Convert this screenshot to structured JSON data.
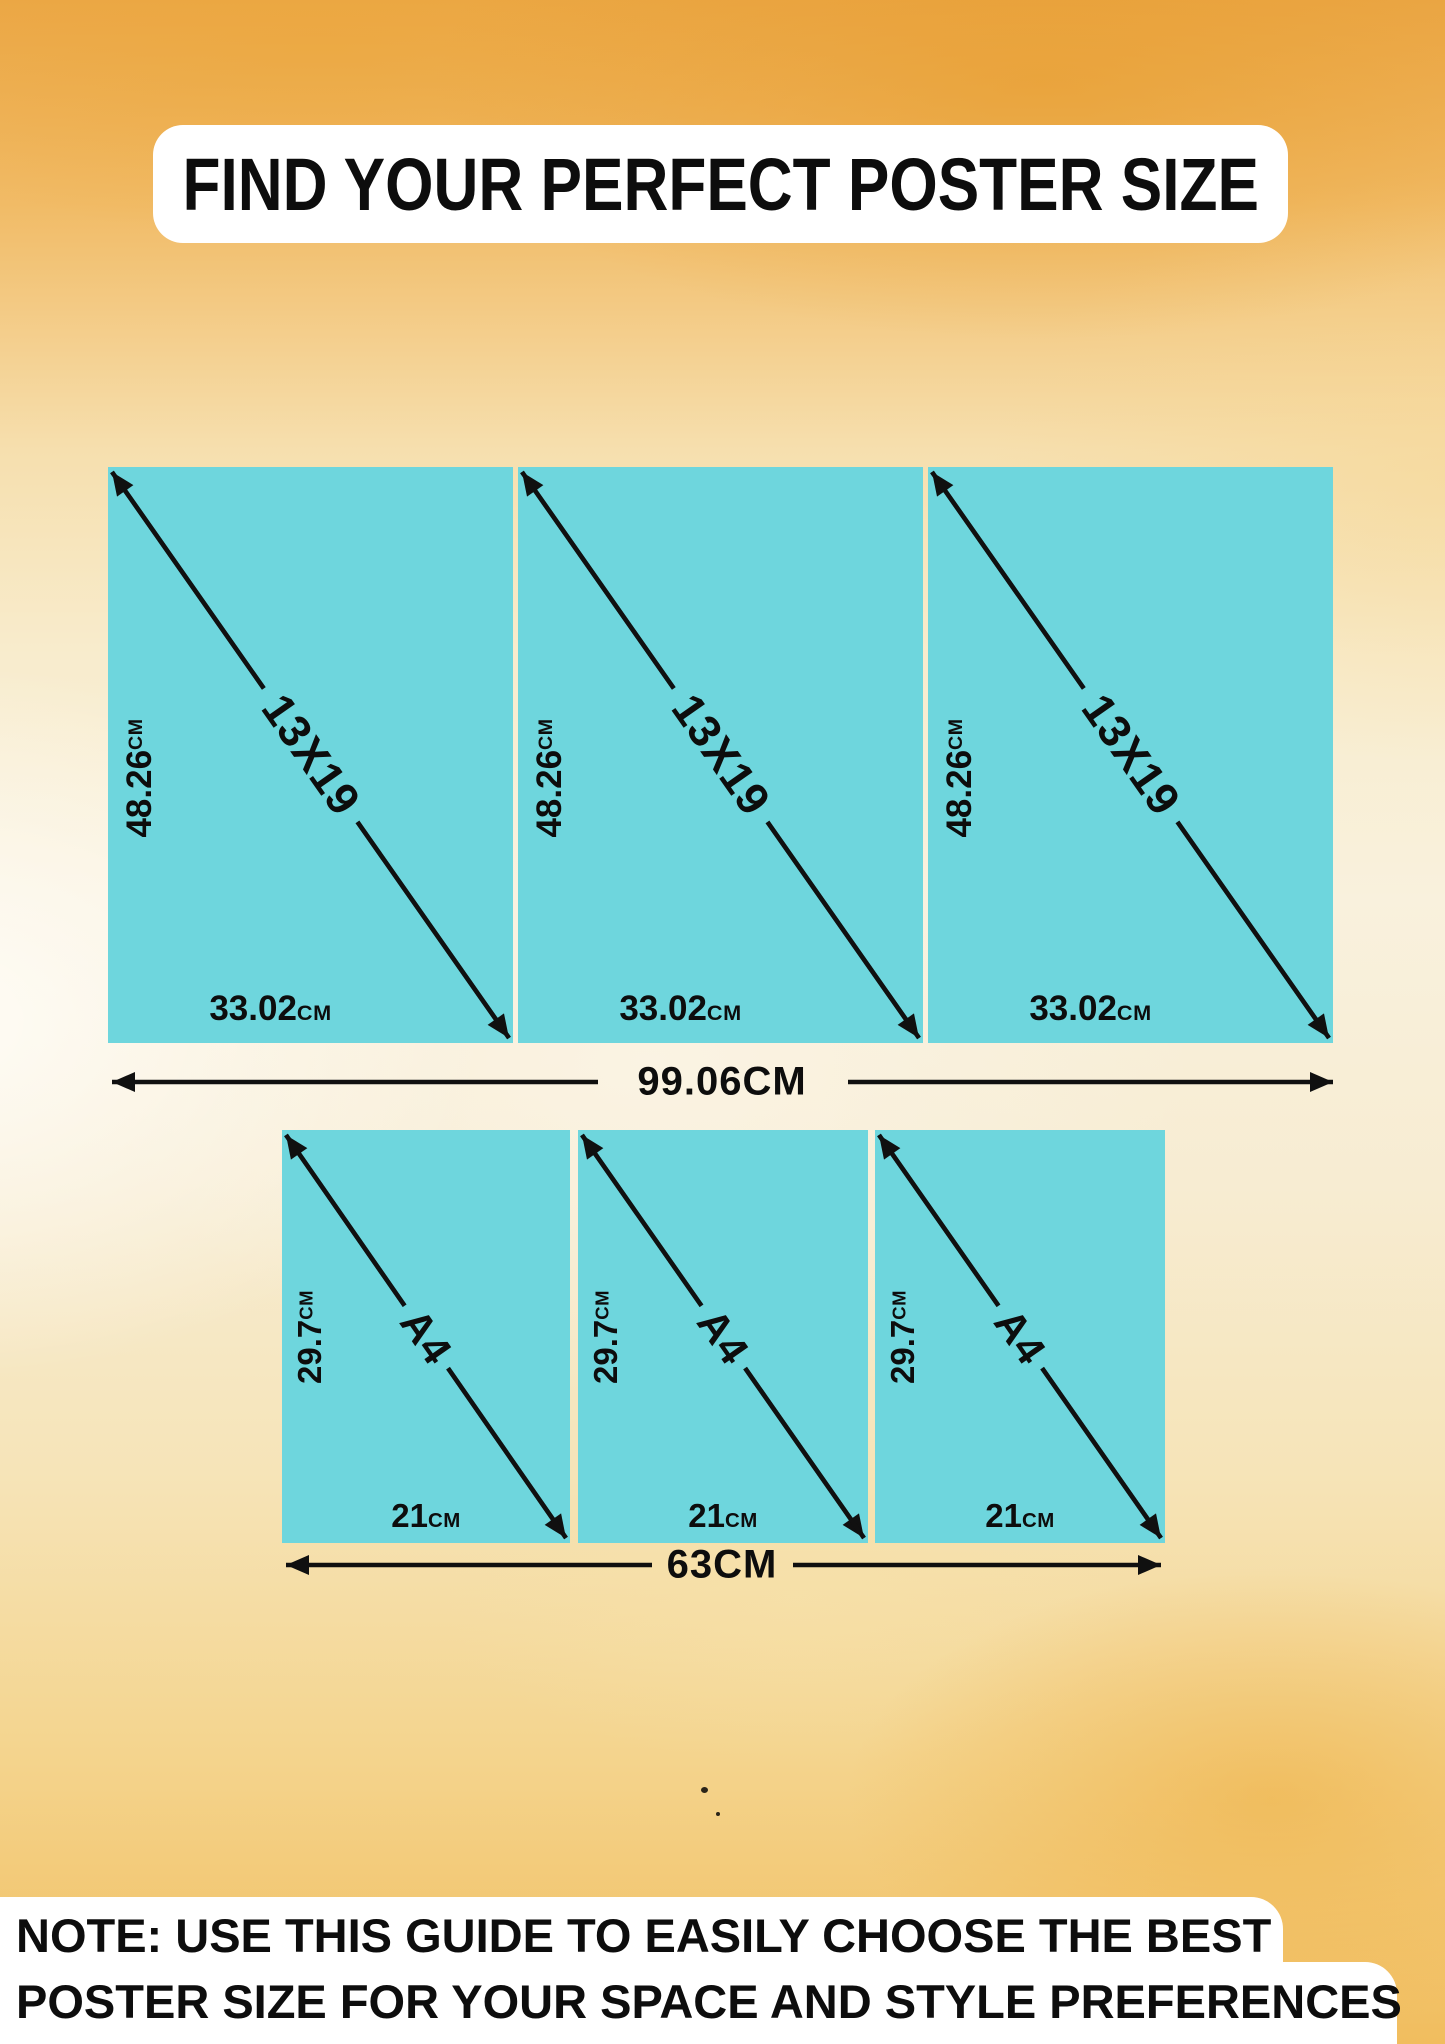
{
  "title": "FIND YOUR PERFECT POSTER SIZE",
  "note": {
    "line1": "NOTE: USE THIS GUIDE TO EASILY CHOOSE THE BEST",
    "line2": "POSTER SIZE FOR YOUR SPACE AND STYLE PREFERENCES"
  },
  "colors": {
    "poster_fill": "#6ed6dd",
    "arrow": "#101010",
    "text": "#0d0d0d",
    "card_background": "#ffffff",
    "background_amber": "#f1bb66"
  },
  "rows": [
    {
      "name": "13x19-row",
      "total_label": "99.06CM",
      "panels": [
        {
          "diagonal": "13X19",
          "height_value": "48.26",
          "height_unit": "CM",
          "width_value": "33.02",
          "width_unit": "CM"
        },
        {
          "diagonal": "13X19",
          "height_value": "48.26",
          "height_unit": "CM",
          "width_value": "33.02",
          "width_unit": "CM"
        },
        {
          "diagonal": "13X19",
          "height_value": "48.26",
          "height_unit": "CM",
          "width_value": "33.02",
          "width_unit": "CM"
        }
      ]
    },
    {
      "name": "a4-row",
      "total_label": "63CM",
      "panels": [
        {
          "diagonal": "A4",
          "height_value": "29.7",
          "height_unit": "CM",
          "width_value": "21",
          "width_unit": "CM"
        },
        {
          "diagonal": "A4",
          "height_value": "29.7",
          "height_unit": "CM",
          "width_value": "21",
          "width_unit": "CM"
        },
        {
          "diagonal": "A4",
          "height_value": "29.7",
          "height_unit": "CM",
          "width_value": "21",
          "width_unit": "CM"
        }
      ]
    }
  ]
}
